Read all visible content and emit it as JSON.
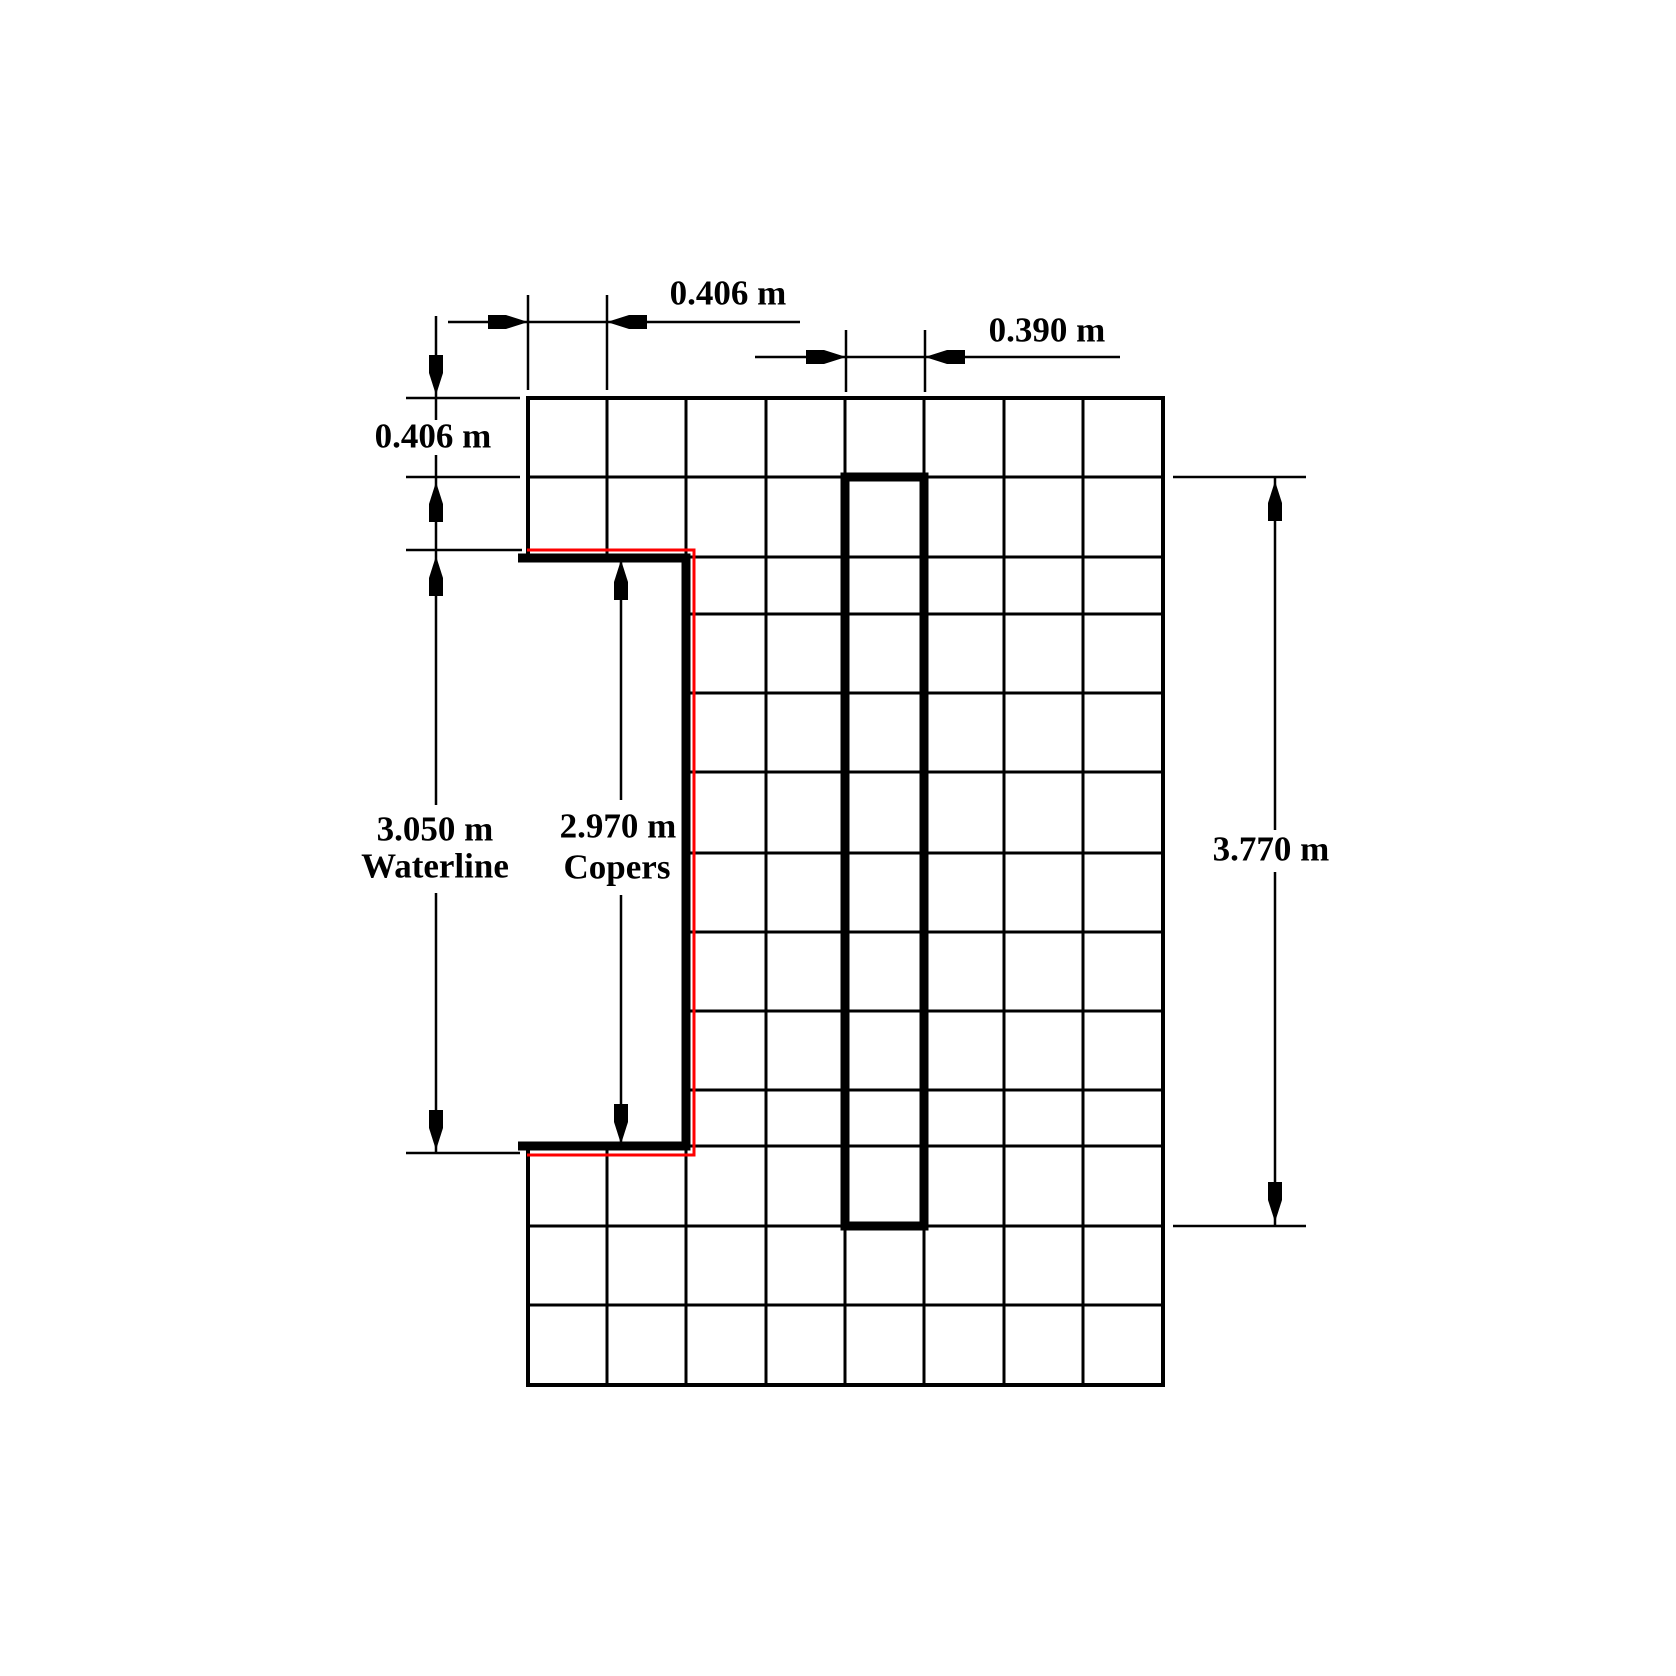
{
  "canvas": {
    "background": "#ffffff",
    "line_color": "#000000",
    "accent_red": "#fe0000"
  },
  "labels": {
    "dim_top_width": "0.406 m",
    "dim_member_width": "0.390 m",
    "dim_course_height": "0.406 m",
    "dim_waterline_value": "3.050 m",
    "dim_waterline_name": "Waterline",
    "dim_copers_value": "2.970 m",
    "dim_copers_name": "Copers",
    "dim_overall_height": "3.770 m"
  },
  "diagram": {
    "type": "masonry-elevation-dimension-drawing",
    "grid": {
      "columns": 8,
      "rows": 13,
      "notch_cut_out": "left side, 2 columns wide, between upper two courses and lower three courses"
    },
    "dimensions": [
      {
        "label": "0.406 m",
        "orientation": "horizontal",
        "position": "top-left",
        "measures": "one block width"
      },
      {
        "label": "0.390 m",
        "orientation": "horizontal",
        "position": "top-right",
        "measures": "vertical member width"
      },
      {
        "label": "0.406 m",
        "orientation": "vertical",
        "position": "left",
        "measures": "one course height"
      },
      {
        "label": "3.050 m Waterline",
        "orientation": "vertical",
        "position": "left-middle",
        "measures": "waterline height of recess"
      },
      {
        "label": "2.970 m Copers",
        "orientation": "vertical",
        "position": "center",
        "measures": "copers height of recess"
      },
      {
        "label": "3.770 m",
        "orientation": "vertical",
        "position": "right",
        "measures": "vertical member overall height"
      }
    ],
    "outlines": [
      {
        "name": "copers-thick-outline",
        "color": "#000000",
        "shape": "C-shaped notch edge"
      },
      {
        "name": "waterline-outline",
        "color": "#fe0000",
        "shape": "open rectangle around notch"
      },
      {
        "name": "vertical-member-outline",
        "color": "#000000",
        "shape": "tall one-column rectangle"
      }
    ]
  }
}
